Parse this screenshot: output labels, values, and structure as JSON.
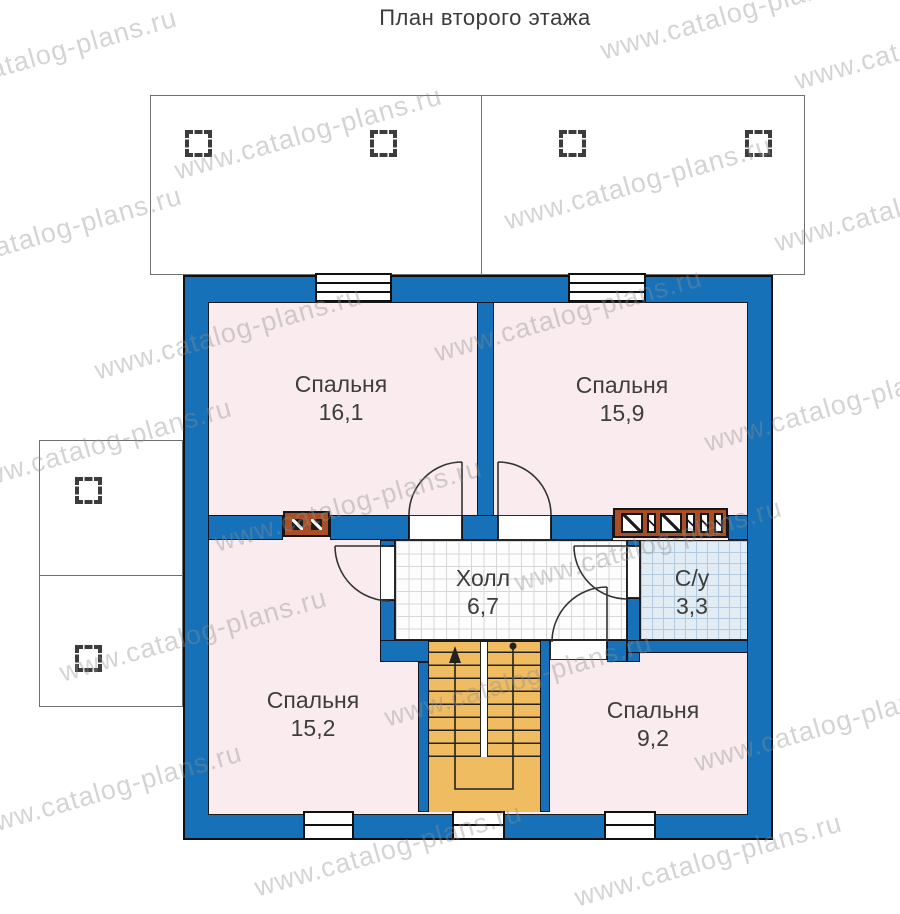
{
  "title": "План второго этажа",
  "watermark_text": "www.catalog-plans.ru",
  "rooms": [
    {
      "id": "bedroom-top-left",
      "name": "Спальня",
      "area": "16,1"
    },
    {
      "id": "bedroom-top-right",
      "name": "Спальня",
      "area": "15,9"
    },
    {
      "id": "bedroom-bottom-left",
      "name": "Спальня",
      "area": "15,2"
    },
    {
      "id": "bedroom-bottom-right",
      "name": "Спальня",
      "area": "9,2"
    },
    {
      "id": "hall",
      "name": "Холл",
      "area": "6,7"
    },
    {
      "id": "bathroom",
      "name": "С/у",
      "area": "3,3"
    }
  ],
  "colors": {
    "wall": "#1671b8",
    "floor_pink": "#f9ebee",
    "stairs": "#f0bc62",
    "bath_tile": "#e2ecf5",
    "vent": "#a94f28"
  }
}
